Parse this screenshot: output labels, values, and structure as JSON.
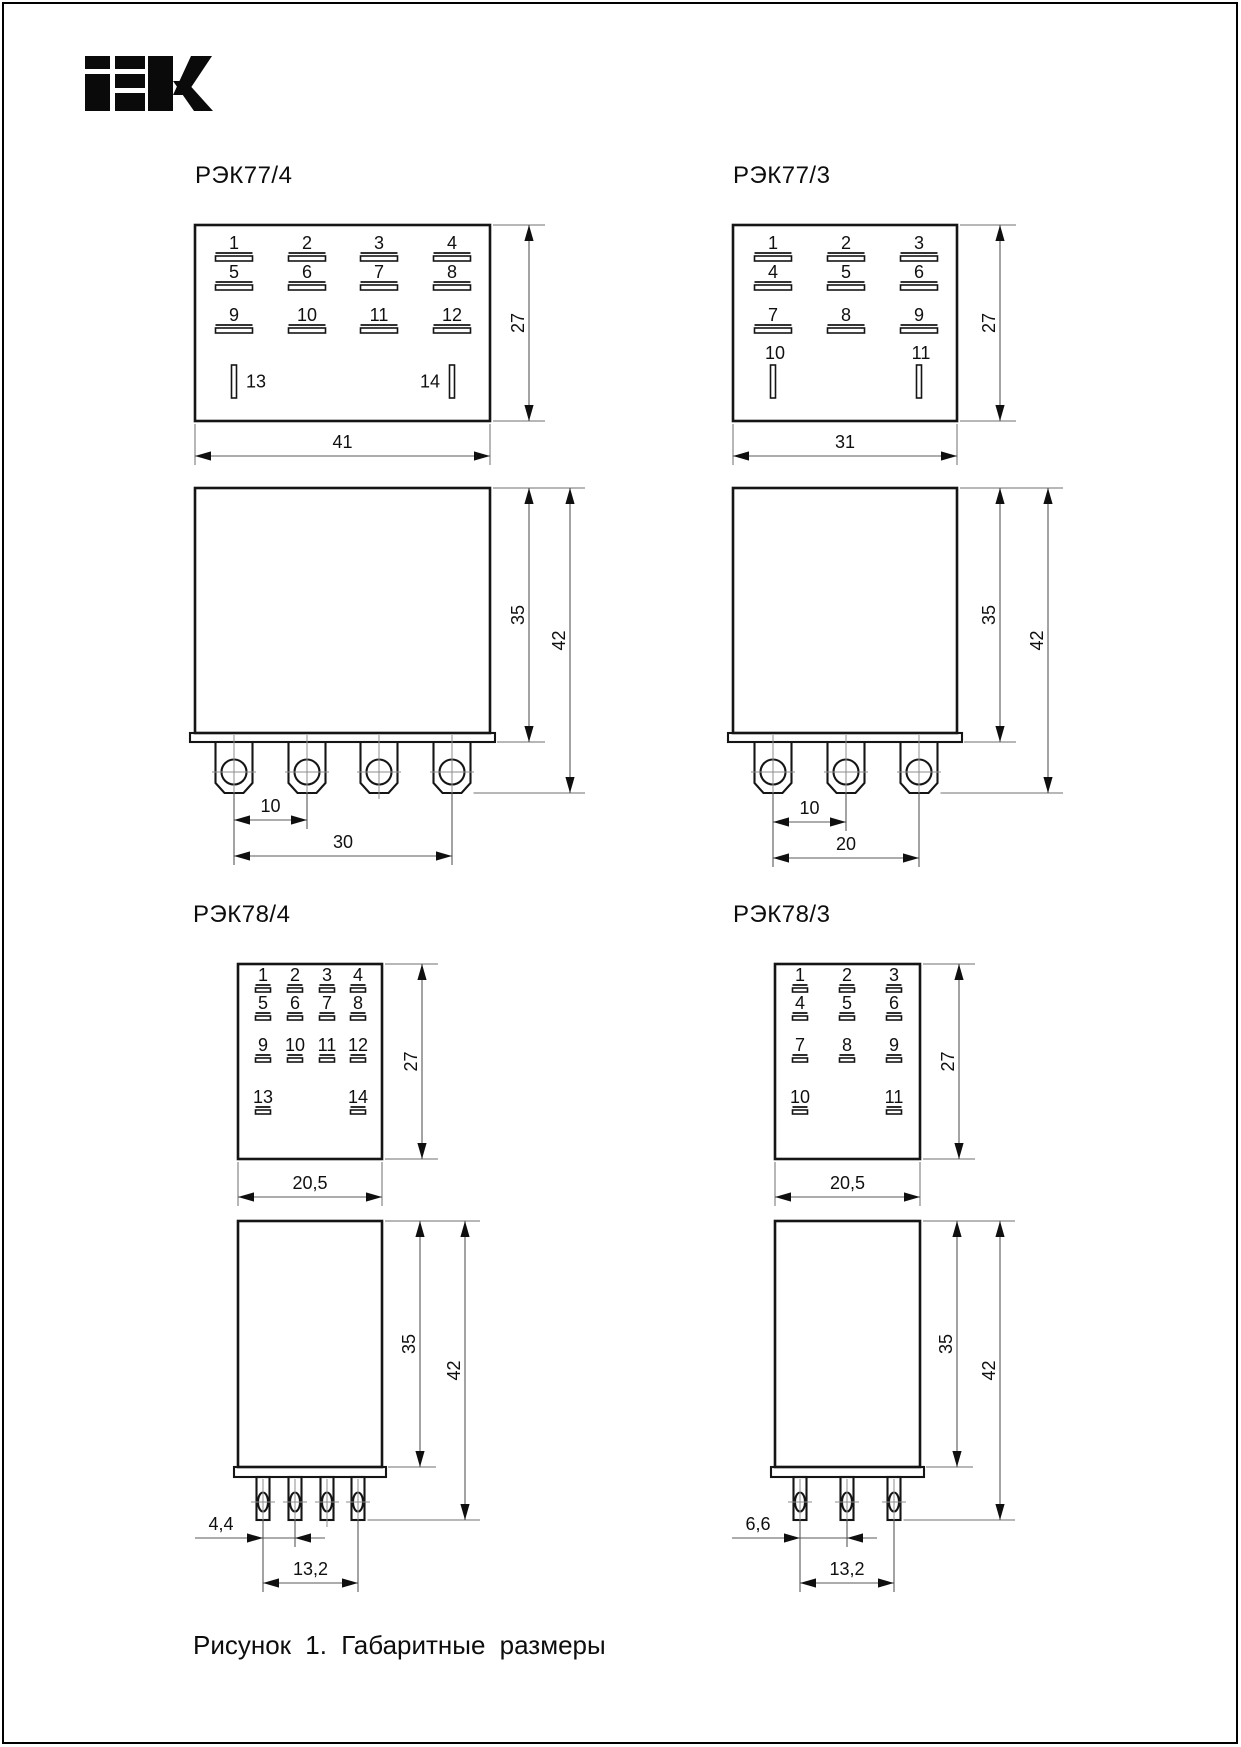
{
  "page": {
    "brand": "IEK",
    "caption": "Рисунок 1. Габаритные размеры"
  },
  "diagrams": [
    {
      "id": "rek77_4",
      "title": "РЭК77/4",
      "top_view": {
        "rows": [
          [
            "1",
            "2",
            "3",
            "4"
          ],
          [
            "5",
            "6",
            "7",
            "8"
          ],
          [
            "9",
            "10",
            "11",
            "12"
          ]
        ],
        "side_terminals": [
          "13",
          "14"
        ]
      },
      "dims": {
        "width": "41",
        "height": "27",
        "body": "35",
        "total": "42",
        "pitch": "10",
        "span": "30"
      }
    },
    {
      "id": "rek77_3",
      "title": "РЭК77/3",
      "top_view": {
        "rows": [
          [
            "1",
            "2",
            "3"
          ],
          [
            "4",
            "5",
            "6"
          ],
          [
            "7",
            "8",
            "9"
          ]
        ],
        "side_terminals": [
          "10",
          "11"
        ]
      },
      "dims": {
        "width": "31",
        "height": "27",
        "body": "35",
        "total": "42",
        "pitch": "10",
        "span": "20"
      }
    },
    {
      "id": "rek78_4",
      "title": "РЭК78/4",
      "top_view": {
        "rows": [
          [
            "1",
            "2",
            "3",
            "4"
          ],
          [
            "5",
            "6",
            "7",
            "8"
          ],
          [
            "9",
            "10",
            "11",
            "12"
          ]
        ],
        "side_terminals": [
          "13",
          "14"
        ]
      },
      "dims": {
        "width": "20,5",
        "height": "27",
        "body": "35",
        "total": "42",
        "pitch": "4,4",
        "span": "13,2"
      }
    },
    {
      "id": "rek78_3",
      "title": "РЭК78/3",
      "top_view": {
        "rows": [
          [
            "1",
            "2",
            "3"
          ],
          [
            "4",
            "5",
            "6"
          ],
          [
            "7",
            "8",
            "9"
          ]
        ],
        "side_terminals": [
          "10",
          "11"
        ]
      },
      "dims": {
        "width": "20,5",
        "height": "27",
        "body": "35",
        "total": "42",
        "pitch": "6,6",
        "span": "13,2"
      }
    }
  ]
}
